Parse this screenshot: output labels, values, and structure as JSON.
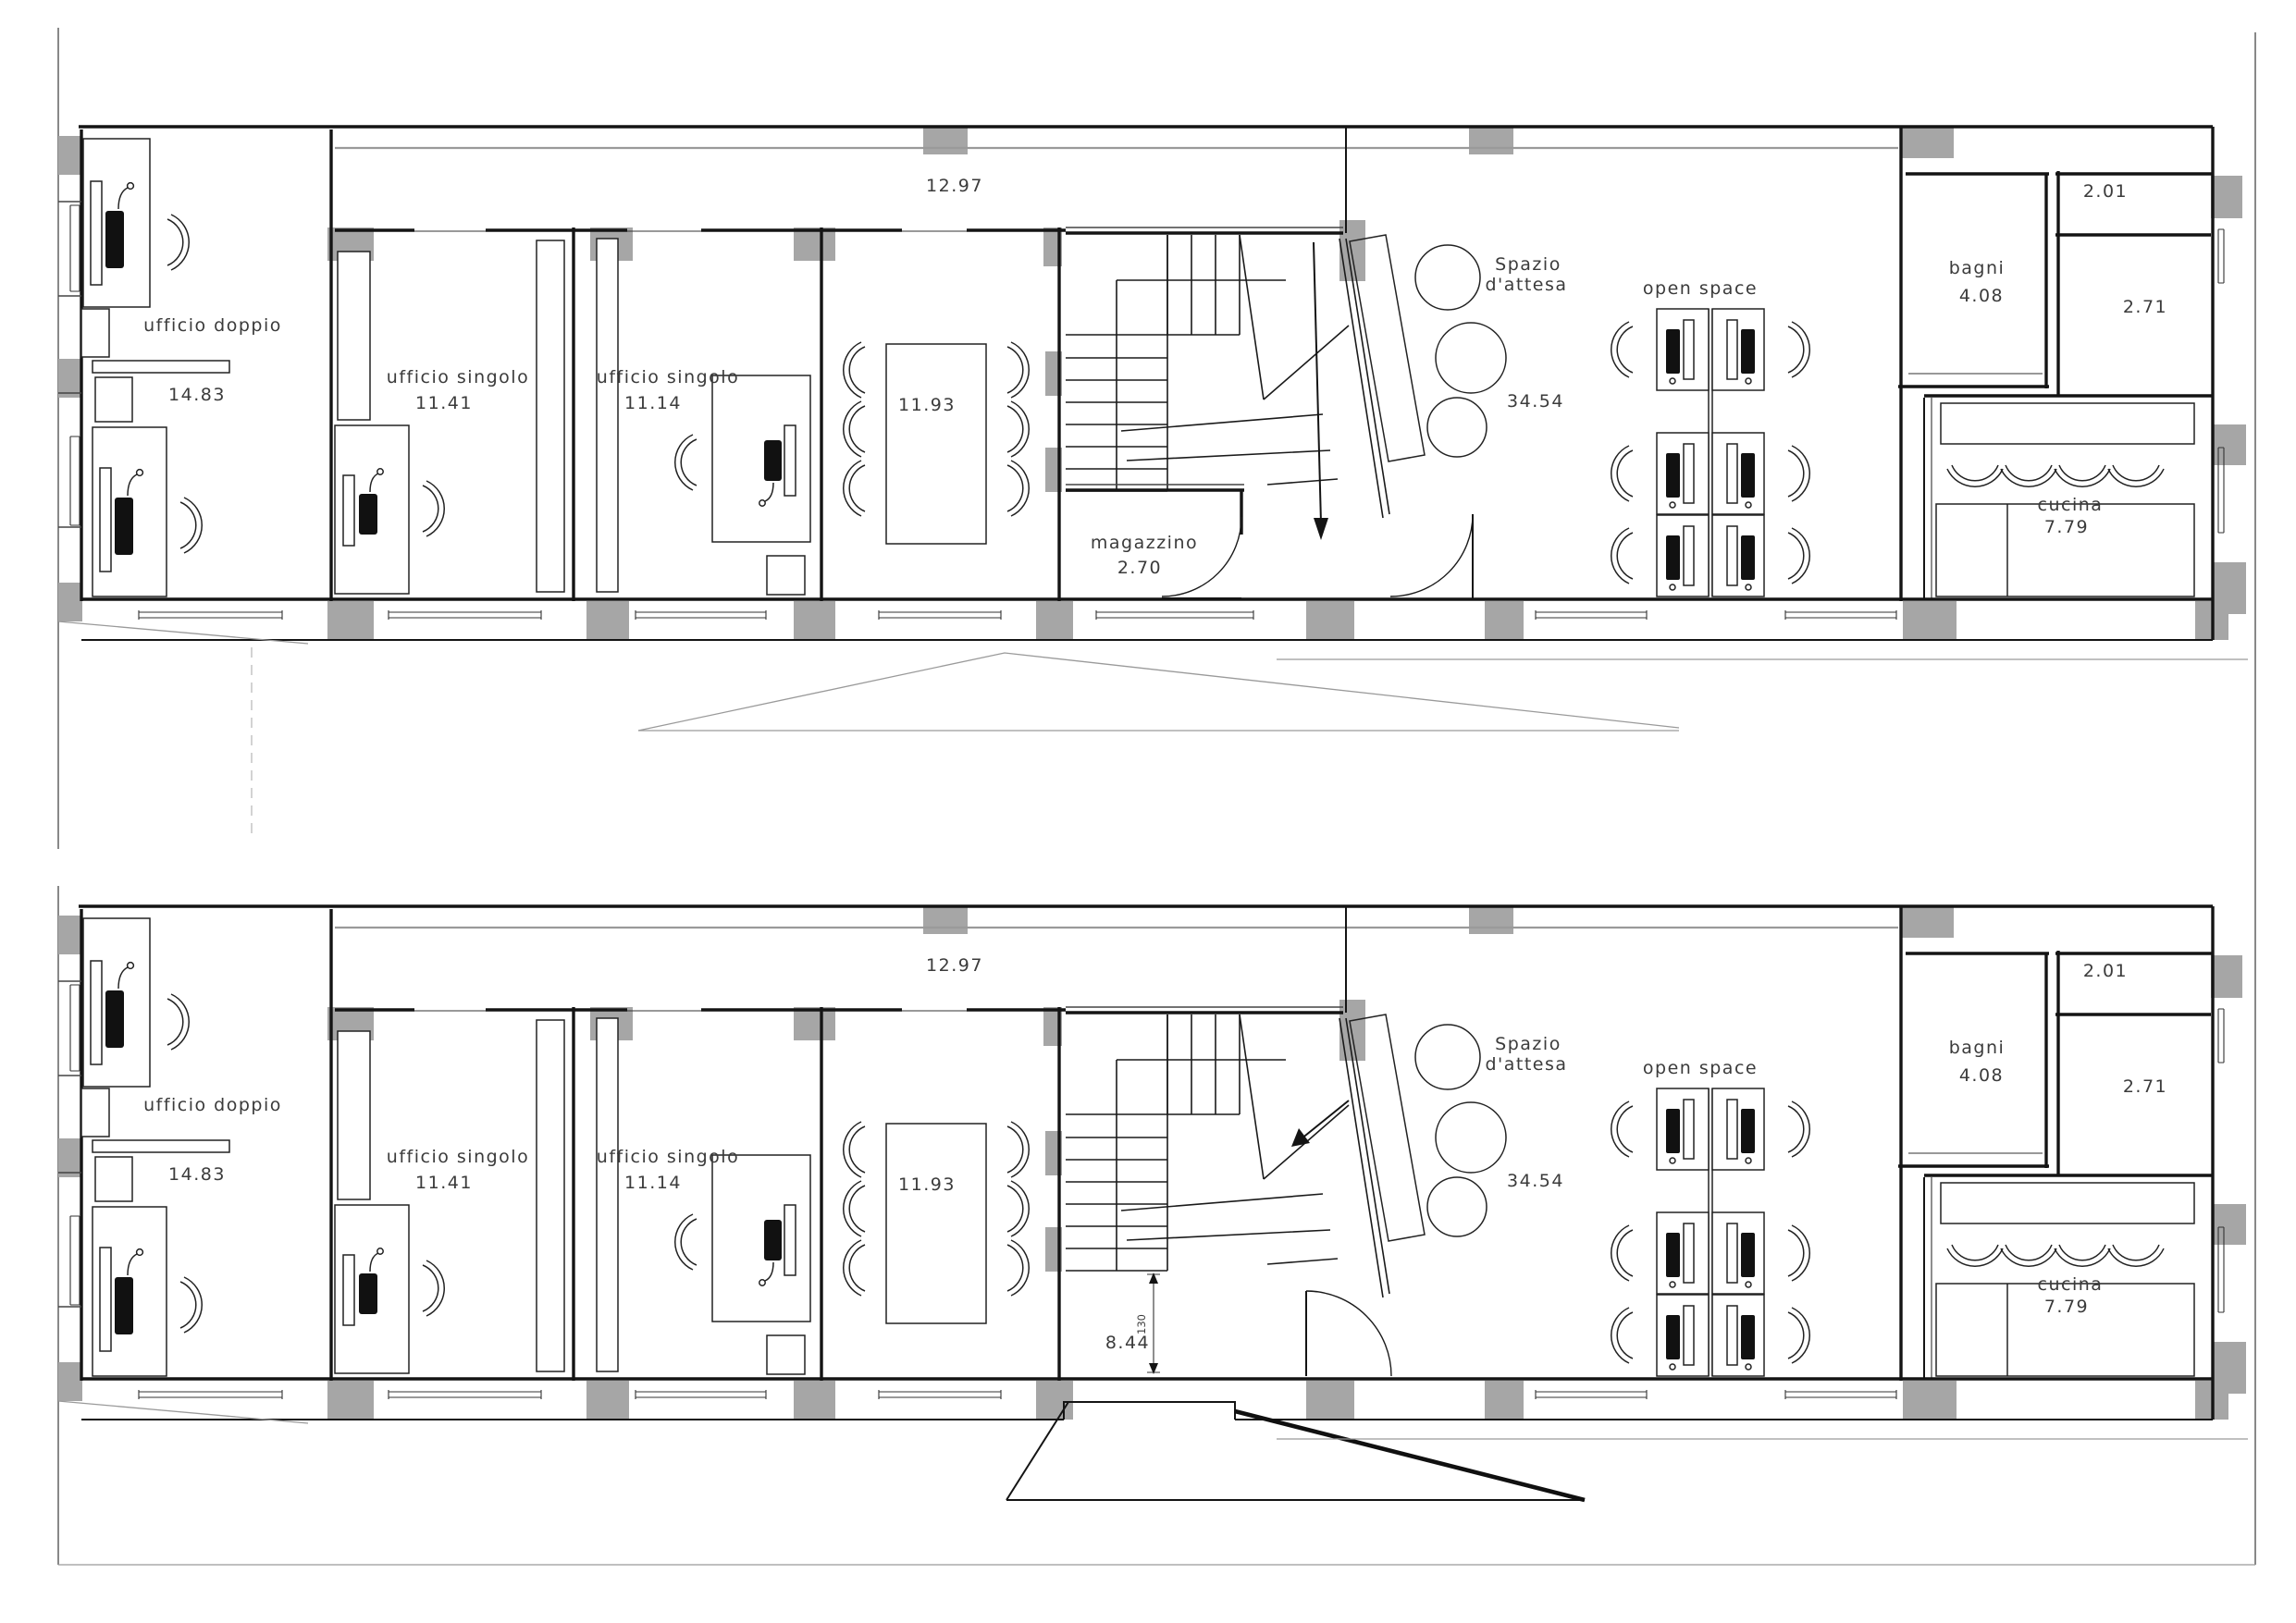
{
  "rooms": {
    "corridor": {
      "area": "12.97"
    },
    "ufficio_doppio": {
      "label": "ufficio doppio",
      "area": "14.83"
    },
    "ufficio_singolo_1": {
      "label": "ufficio singolo",
      "area": "11.41"
    },
    "ufficio_singolo_2": {
      "label": "ufficio singolo",
      "area": "11.14"
    },
    "sala_riunioni": {
      "area": "11.93"
    },
    "spazio_attesa": {
      "label_line1": "Spazio",
      "label_line2": "d'attesa",
      "area": "34.54"
    },
    "open_space": {
      "label": "open space"
    },
    "bagni": {
      "label": "bagni",
      "area": "4.08"
    },
    "wc_1": {
      "area": "2.01"
    },
    "wc_2": {
      "area": "2.71"
    },
    "cucina": {
      "label": "cucina",
      "area": "7.79"
    }
  },
  "floor_upper": {
    "magazzino": {
      "label": "magazzino",
      "area": "2.70"
    }
  },
  "floor_lower": {
    "stair_hall_area": "8.44",
    "step_dimension": "130"
  },
  "colors": {
    "wall": "#141414",
    "pillar_fill": "#a6a6a6",
    "background": "#ffffff"
  }
}
